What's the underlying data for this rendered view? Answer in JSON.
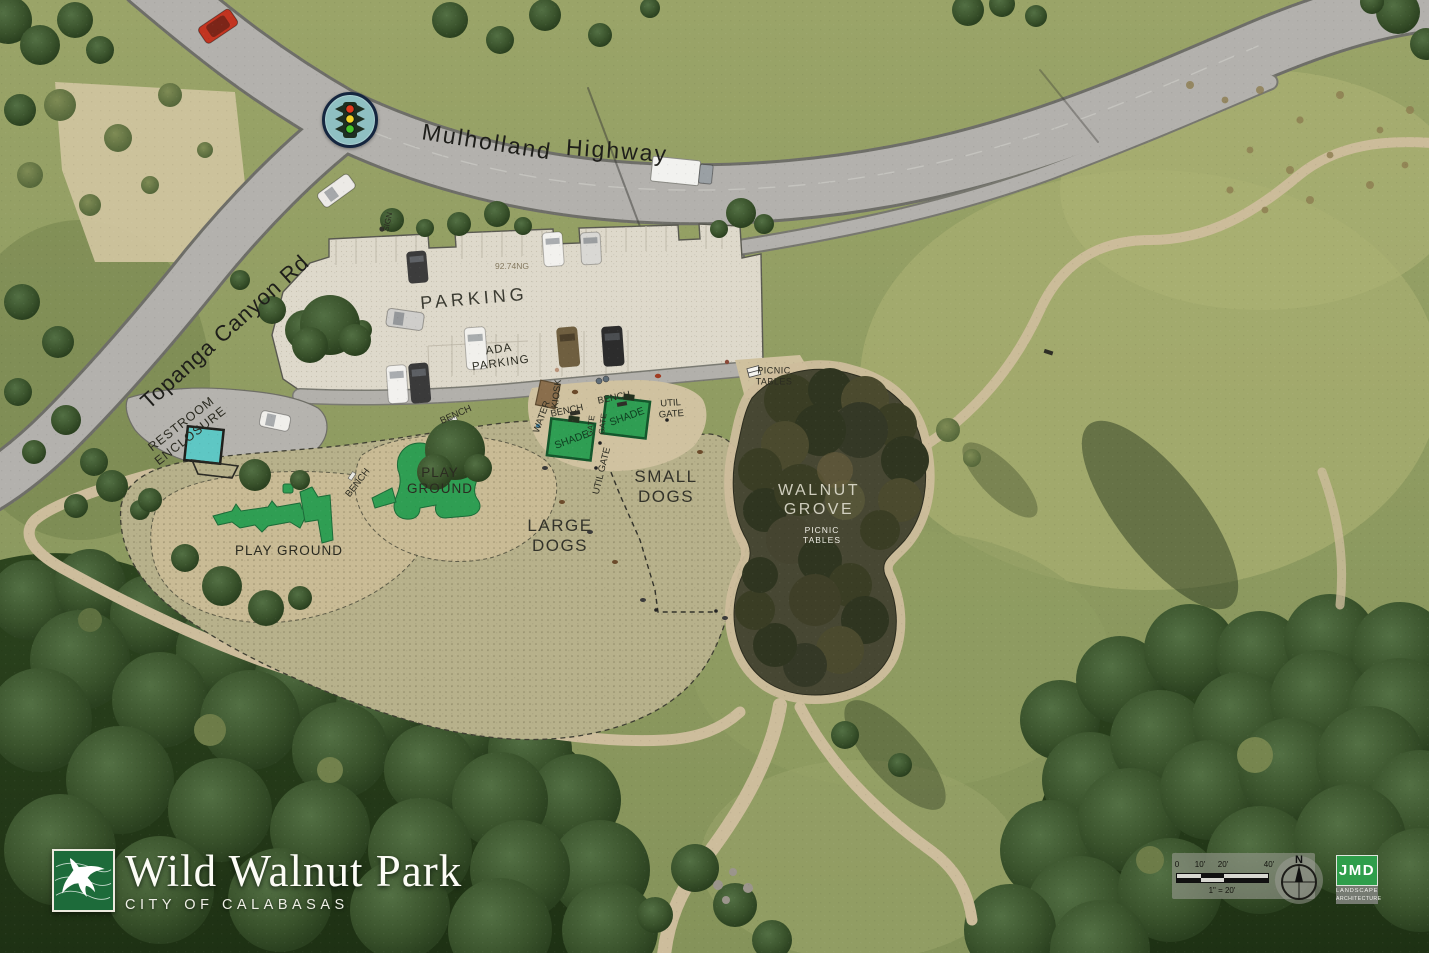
{
  "map": {
    "roads": {
      "mulholland_word1": "Mulholland",
      "mulholland_word2": "Highway",
      "topanga": "Topanga Canyon Rd",
      "sign": "SIGN"
    },
    "parking": {
      "main": "PARKING",
      "ada": "ADA\nPARKING",
      "elevation_note": "92.74NG"
    },
    "facilities": {
      "restroom": "RESTROOM\nENCLOSURE",
      "kiosk": "KIOSK",
      "water": "WATER",
      "bench": "BENCH",
      "shade": "SHADE",
      "gate": "GATE",
      "util_gate": "UTIL\nGATE",
      "util_gate_inline": "UTIL GATE",
      "picnic_tables": "PICNIC\nTABLES"
    },
    "zones": {
      "small_dogs": "SMALL\nDOGS",
      "large_dogs": "LARGE\nDOGS",
      "playground_left": "PLAY GROUND",
      "playground_mid": "PLAY\nGROUND",
      "walnut_grove": "WALNUT\nGROVE",
      "grove_picnic": "PICNIC\nTABLES"
    }
  },
  "branding": {
    "park_name": "Wild Walnut Park",
    "city": "CITY OF CALABASAS"
  },
  "scale_bar": {
    "tick_0": "0",
    "tick_10": "10'",
    "tick_20": "20'",
    "tick_40": "40'",
    "ratio": "1\" = 20'",
    "north": "N"
  },
  "credit": {
    "firm": "JMD",
    "firm_line1": "LANDSCAPE",
    "firm_line2": "ARCHITECTURE"
  },
  "colors": {
    "accent_green": "#2f9e53",
    "restroom_teal": "#5ec7c4",
    "logo_green": "#1d6b3a",
    "credit_green": "#2f9e4b"
  }
}
